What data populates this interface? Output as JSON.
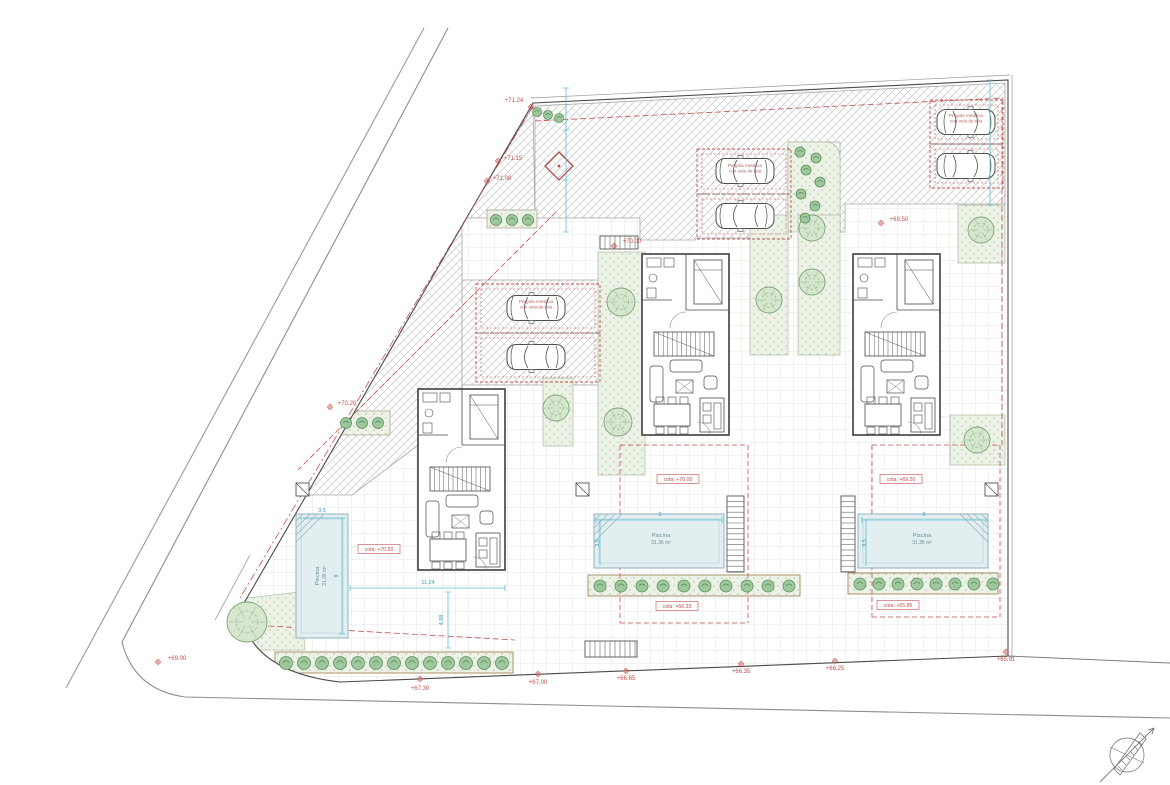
{
  "meta": {
    "drawing_type": "Architectural site plan with three villas, pools, parking pergolas and landscaping"
  },
  "colors": {
    "annotation_red": "#c0504d",
    "dimension_cyan": "#2fa3bd",
    "pool_fill": "#e3eef0",
    "green_fill": "#edf2e7",
    "line_dark": "#4a4a4a"
  },
  "icons": [
    {
      "name": "tree-icon",
      "shape": "scalloped-circle"
    },
    {
      "name": "bush-icon",
      "shape": "small-green-circle"
    },
    {
      "name": "car-icon",
      "shape": "top-view-car"
    },
    {
      "name": "compass-icon",
      "shape": "circle-with-north-needle"
    },
    {
      "name": "survey-diamond-icon",
      "shape": "rotated-red-square"
    },
    {
      "name": "utility-box-icon",
      "shape": "square-with-diagonal"
    },
    {
      "name": "stairs-icon",
      "shape": "treads"
    },
    {
      "name": "level-marker-icon",
      "shape": "crossed-circle"
    }
  ],
  "annotations": {
    "pergola": {
      "lines": [
        "Pérgola metálica",
        "con vela de tela"
      ],
      "positions": [
        {
          "x": 536,
          "y": 303
        },
        {
          "x": 745,
          "y": 167
        },
        {
          "x": 966,
          "y": 117
        }
      ]
    },
    "elevation_labels": [
      {
        "text": "+71.24",
        "x": 514,
        "y": 102,
        "mx": 531,
        "my": 107
      },
      {
        "text": "+71.15",
        "x": 513,
        "y": 160,
        "mx": 498,
        "my": 161
      },
      {
        "text": "+71.08",
        "x": 502,
        "y": 180,
        "mx": 487,
        "my": 181
      },
      {
        "text": "+70.20",
        "x": 347,
        "y": 405,
        "mx": 330,
        "my": 407
      },
      {
        "text": "+70.00",
        "x": 632,
        "y": 243,
        "mx": 614,
        "my": 246
      },
      {
        "text": "+69.50",
        "x": 899,
        "y": 221,
        "mx": 881,
        "my": 223
      },
      {
        "text": "+69.00",
        "x": 177,
        "y": 660,
        "mx": 158,
        "my": 662
      },
      {
        "text": "+67.30",
        "x": 420,
        "y": 690,
        "mx": 420,
        "my": 679
      },
      {
        "text": "+67.00",
        "x": 538,
        "y": 684,
        "mx": 538,
        "my": 674
      },
      {
        "text": "+66.65",
        "x": 626,
        "y": 680,
        "mx": 626,
        "my": 671
      },
      {
        "text": "+66.35",
        "x": 741,
        "y": 673,
        "mx": 741,
        "my": 664
      },
      {
        "text": "+66.25",
        "x": 835,
        "y": 670,
        "mx": 835,
        "my": 661
      },
      {
        "text": "+65.91",
        "x": 1006,
        "y": 661,
        "mx": 1006,
        "my": 652
      }
    ],
    "cota_labels": [
      {
        "text": "cota: +70.50",
        "x": 379,
        "y": 551
      },
      {
        "text": "cota: +70.00",
        "x": 678,
        "y": 481
      },
      {
        "text": "cota: +69.50",
        "x": 901,
        "y": 481
      },
      {
        "text": "cota: +66.33",
        "x": 677,
        "y": 608
      },
      {
        "text": "cota: +65.86",
        "x": 898,
        "y": 607
      }
    ],
    "pool_labels": [
      {
        "line1": "Piscina",
        "line2": "31,36 m²",
        "x": 661,
        "y": 539,
        "rotate": 0
      },
      {
        "line1": "Piscina",
        "line2": "31,36 m²",
        "x": 922,
        "y": 539,
        "rotate": 0
      },
      {
        "line1": "Piscina",
        "line2": "31,36 m²",
        "x": 321,
        "y": 576,
        "rotate": -90
      }
    ],
    "dimension_labels": [
      {
        "text": "9",
        "x": 660,
        "y": 516,
        "rotate": 0
      },
      {
        "text": "3,5",
        "x": 599,
        "y": 543,
        "rotate": -90
      },
      {
        "text": "9",
        "x": 924,
        "y": 516,
        "rotate": 0
      },
      {
        "text": "3,5",
        "x": 866,
        "y": 543,
        "rotate": -90
      },
      {
        "text": "9",
        "x": 338,
        "y": 576,
        "rotate": -90
      },
      {
        "text": "3,5",
        "x": 322,
        "y": 512,
        "rotate": 0
      },
      {
        "text": "11,24",
        "x": 428,
        "y": 584,
        "rotate": 0
      },
      {
        "text": "4,98",
        "x": 443,
        "y": 620,
        "rotate": -90
      }
    ]
  }
}
